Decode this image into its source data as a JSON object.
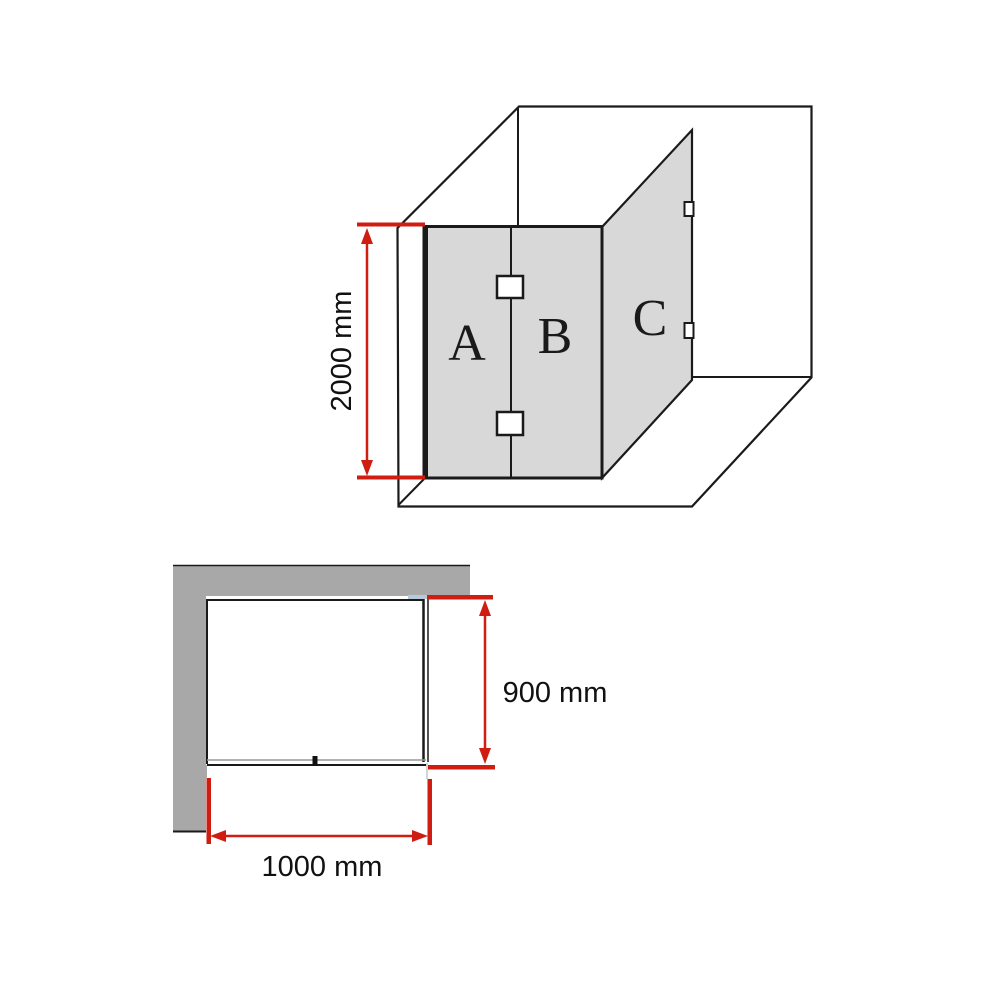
{
  "colors": {
    "dimension_red": "#cf1d12",
    "panel_gray": "#d8d8d8",
    "wall_gray": "#a8a8a8",
    "line_dark": "#1a1a1a",
    "seam_blue": "#b7c9da"
  },
  "perspective_view": {
    "panels": [
      {
        "id": "A",
        "label": "A"
      },
      {
        "id": "B",
        "label": "B"
      },
      {
        "id": "C",
        "label": "C"
      }
    ],
    "height_dimension": {
      "label": "2000 mm"
    }
  },
  "plan_view": {
    "depth_dimension": {
      "label": "900 mm"
    },
    "width_dimension": {
      "label": "1000 mm"
    }
  }
}
